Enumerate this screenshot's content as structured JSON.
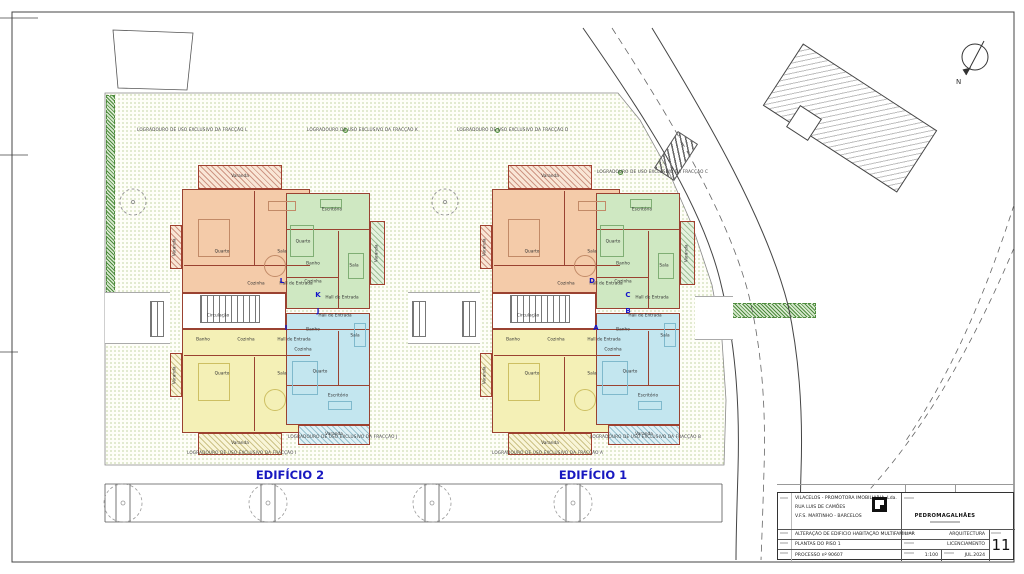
{
  "plan": {
    "building1_label": "EDIFÍCIO 1",
    "building2_label": "EDIFÍCIO 2",
    "building1_letters": [
      "D",
      "C",
      "B",
      "A"
    ],
    "building2_letters": [
      "L",
      "K",
      "J",
      "I"
    ],
    "rooms": {
      "varanda": "Varanda",
      "quarto": "Quarto",
      "sala": "Sala",
      "cozinha": "Cozinha",
      "hall": "Hall de Entrada",
      "escritorio": "Escritório",
      "banho": "Banho",
      "circulacao": "Circulação"
    },
    "north": "N",
    "logradouros": [
      "LOGRADOURO DE USO EXCLUSIVO DA FRACÇÃO L",
      "LOGRADOURO DE USO EXCLUSIVO DA FRACÇÃO K",
      "LOGRADOURO DE USO EXCLUSIVO DA FRACÇÃO D",
      "LOGRADOURO DE USO EXCLUSIVO DA FRACÇÃO C",
      "LOGRADOURO DE USO EXCLUSIVO DA FRACÇÃO J",
      "LOGRADOURO DE USO EXCLUSIVO DA FRACÇÃO B",
      "LOGRADOURO DE USO EXCLUSIVO DA FRACÇÃO I",
      "LOGRADOURO DE USO EXCLUSIVO DA FRACÇÃO A"
    ]
  },
  "titleblock": {
    "client": "VILACELOS - PROMOTORA IMOBILIARIA, Lda.",
    "address1": "RUA LUIS DE CAMÕES",
    "address2": "V.F.S. MARTINHO - BARCELOS",
    "project": "ALTERAÇÃO DE EDIFICIO HABITAÇÃO MULTIFAMILIAR",
    "drawing": "PLANTAS DO PISO 1",
    "process": "PROCESSO nº 90607",
    "firm": "PEDROMAGALHÃES",
    "specialty": "ARQUITECTURA",
    "phase": "LICENCIAMENTO",
    "scale": "1:100",
    "date": "JUL.2024",
    "sheet_number": "11"
  }
}
